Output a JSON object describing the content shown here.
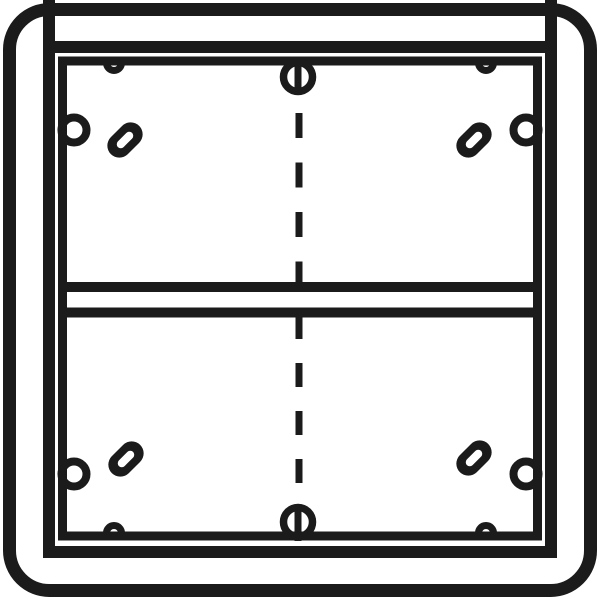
{
  "drawing": {
    "name": "surface-mount-frame-technical-drawing",
    "description": "black line technical drawing of a two-module surface mount frame",
    "canvas": {
      "width": 600,
      "height": 600
    },
    "colors": {
      "line": "#1b1b1b",
      "background": "#ffffff"
    },
    "shapes": [
      {
        "name": "outer-frame",
        "interactable": false,
        "tag": "rect",
        "attrs": {
          "x": 9.5,
          "y": 9.5,
          "width": 581,
          "height": 581,
          "rx": 40,
          "ry": 40,
          "fill": "none",
          "stroke": "#1b1b1b",
          "stroke-width": 13
        }
      },
      {
        "name": "corner-tick-top-left",
        "interactable": false,
        "tag": "line",
        "attrs": {
          "x1": 49,
          "y1": 0,
          "x2": 49,
          "y2": 53,
          "stroke": "#1b1b1b",
          "stroke-width": 12
        }
      },
      {
        "name": "corner-tick-top-right",
        "interactable": false,
        "tag": "line",
        "attrs": {
          "x1": 551,
          "y1": 0,
          "x2": 551,
          "y2": 53,
          "stroke": "#1b1b1b",
          "stroke-width": 12
        }
      },
      {
        "name": "frame-inner-edge",
        "interactable": false,
        "tag": "rect",
        "attrs": {
          "x": 49,
          "y": 47,
          "width": 502,
          "height": 505,
          "fill": "none",
          "stroke": "#1b1b1b",
          "stroke-width": 12
        }
      },
      {
        "name": "mounting-box-outline",
        "interactable": false,
        "tag": "rect",
        "attrs": {
          "x": 62.5,
          "y": 61,
          "width": 475,
          "height": 475,
          "fill": "none",
          "stroke": "#1b1b1b",
          "stroke-width": 9
        }
      },
      {
        "name": "divider-bar-upper-line",
        "interactable": false,
        "tag": "line",
        "attrs": {
          "x1": 66,
          "y1": 287,
          "x2": 534,
          "y2": 287,
          "stroke": "#1b1b1b",
          "stroke-width": 10,
          "stroke-linecap": "round"
        }
      },
      {
        "name": "divider-bar-lower-line",
        "interactable": false,
        "tag": "line",
        "attrs": {
          "x1": 66,
          "y1": 312.5,
          "x2": 534,
          "y2": 312.5,
          "stroke": "#1b1b1b",
          "stroke-width": 10,
          "stroke-linecap": "round"
        }
      },
      {
        "name": "center-dashed-line-top",
        "interactable": false,
        "tag": "line",
        "attrs": {
          "x1": 299,
          "y1": 113,
          "x2": 299,
          "y2": 287,
          "stroke": "#1b1b1b",
          "stroke-width": 7,
          "stroke-dasharray": "25 24.5"
        }
      },
      {
        "name": "center-dashed-line-bottom",
        "interactable": false,
        "tag": "line",
        "attrs": {
          "x1": 299,
          "y1": 315,
          "x2": 299,
          "y2": 510,
          "stroke": "#1b1b1b",
          "stroke-width": 7,
          "stroke-dasharray": "24 24"
        }
      },
      {
        "name": "screw-head-top-circle",
        "interactable": false,
        "tag": "circle",
        "attrs": {
          "cx": 298,
          "cy": 77,
          "r": 14.5,
          "fill": "none",
          "stroke": "#1b1b1b",
          "stroke-width": 7.5
        }
      },
      {
        "name": "screw-head-top-slot",
        "interactable": false,
        "tag": "line",
        "attrs": {
          "x1": 298,
          "y1": 58,
          "x2": 298,
          "y2": 94,
          "stroke": "#1b1b1b",
          "stroke-width": 7
        }
      },
      {
        "name": "screw-head-bottom-circle",
        "interactable": false,
        "tag": "circle",
        "attrs": {
          "cx": 298,
          "cy": 522,
          "r": 14.5,
          "fill": "none",
          "stroke": "#1b1b1b",
          "stroke-width": 7.5
        }
      },
      {
        "name": "screw-head-bottom-slot",
        "interactable": false,
        "tag": "line",
        "attrs": {
          "x1": 298,
          "y1": 505,
          "x2": 298,
          "y2": 541,
          "stroke": "#1b1b1b",
          "stroke-width": 7
        }
      },
      {
        "name": "wall-notch-left-top",
        "interactable": false,
        "tag": "circle",
        "attrs": {
          "cx": 74,
          "cy": 130,
          "r": 12.5,
          "fill": "none",
          "stroke": "#1b1b1b",
          "stroke-width": 8
        }
      },
      {
        "name": "wall-notch-right-top",
        "interactable": false,
        "tag": "circle",
        "attrs": {
          "cx": 526,
          "cy": 130,
          "r": 12.5,
          "fill": "none",
          "stroke": "#1b1b1b",
          "stroke-width": 8
        }
      },
      {
        "name": "wall-notch-left-bottom",
        "interactable": false,
        "tag": "circle",
        "attrs": {
          "cx": 74,
          "cy": 474,
          "r": 12.5,
          "fill": "none",
          "stroke": "#1b1b1b",
          "stroke-width": 8
        }
      },
      {
        "name": "wall-notch-right-bottom",
        "interactable": false,
        "tag": "circle",
        "attrs": {
          "cx": 526,
          "cy": 474,
          "r": 12.5,
          "fill": "none",
          "stroke": "#1b1b1b",
          "stroke-width": 8
        }
      },
      {
        "name": "edge-bump-top-left",
        "interactable": false,
        "tag": "path",
        "attrs": {
          "d": "M 106.5 63 A 7.5 7.5 0 0 0 121.5 63",
          "fill": "none",
          "stroke": "#1b1b1b",
          "stroke-width": 7
        }
      },
      {
        "name": "edge-bump-top-right",
        "interactable": false,
        "tag": "path",
        "attrs": {
          "d": "M 478.5 63 A 7.5 7.5 0 0 0 493.5 63",
          "fill": "none",
          "stroke": "#1b1b1b",
          "stroke-width": 7
        }
      },
      {
        "name": "edge-bump-bottom-left",
        "interactable": false,
        "tag": "path",
        "attrs": {
          "d": "M 106.5 533 A 7.5 7.5 0 0 1 121.5 533",
          "fill": "none",
          "stroke": "#1b1b1b",
          "stroke-width": 7
        }
      },
      {
        "name": "edge-bump-bottom-right",
        "interactable": false,
        "tag": "path",
        "attrs": {
          "d": "M 478.5 533 A 7.5 7.5 0 0 1 493.5 533",
          "fill": "none",
          "stroke": "#1b1b1b",
          "stroke-width": 7
        }
      },
      {
        "name": "screw-slot-hole-top-left-body",
        "interactable": false,
        "tag": "rect",
        "attrs": {
          "x": -12,
          "y": -20,
          "width": 24,
          "height": 40,
          "rx": 12,
          "ry": 12,
          "fill": "#1b1b1b",
          "transform": "translate(125,140) rotate(45)"
        }
      },
      {
        "name": "screw-slot-hole-top-left-slot",
        "interactable": false,
        "tag": "rect",
        "attrs": {
          "x": -4,
          "y": -10,
          "width": 8,
          "height": 20,
          "rx": 4,
          "ry": 4,
          "fill": "#ffffff",
          "transform": "translate(125,140) rotate(45)"
        }
      },
      {
        "name": "screw-slot-hole-top-right-body",
        "interactable": false,
        "tag": "rect",
        "attrs": {
          "x": -12,
          "y": -20,
          "width": 24,
          "height": 40,
          "rx": 12,
          "ry": 12,
          "fill": "#1b1b1b",
          "transform": "translate(474,140) rotate(45)"
        }
      },
      {
        "name": "screw-slot-hole-top-right-slot",
        "interactable": false,
        "tag": "rect",
        "attrs": {
          "x": -4,
          "y": -10,
          "width": 8,
          "height": 20,
          "rx": 4,
          "ry": 4,
          "fill": "#ffffff",
          "transform": "translate(474,140) rotate(45)"
        }
      },
      {
        "name": "screw-slot-hole-bottom-left-body",
        "interactable": false,
        "tag": "rect",
        "attrs": {
          "x": -12,
          "y": -20,
          "width": 24,
          "height": 40,
          "rx": 12,
          "ry": 12,
          "fill": "#1b1b1b",
          "transform": "translate(126,459) rotate(45)"
        }
      },
      {
        "name": "screw-slot-hole-bottom-left-slot",
        "interactable": false,
        "tag": "rect",
        "attrs": {
          "x": -4,
          "y": -10,
          "width": 8,
          "height": 20,
          "rx": 4,
          "ry": 4,
          "fill": "#ffffff",
          "transform": "translate(126,459) rotate(45)"
        }
      },
      {
        "name": "screw-slot-hole-bottom-right-body",
        "interactable": false,
        "tag": "rect",
        "attrs": {
          "x": -12,
          "y": -20,
          "width": 24,
          "height": 40,
          "rx": 12,
          "ry": 12,
          "fill": "#1b1b1b",
          "transform": "translate(474,458) rotate(45)"
        }
      },
      {
        "name": "screw-slot-hole-bottom-right-slot",
        "interactable": false,
        "tag": "rect",
        "attrs": {
          "x": -4,
          "y": -10,
          "width": 8,
          "height": 20,
          "rx": 4,
          "ry": 4,
          "fill": "#ffffff",
          "transform": "translate(474,458) rotate(45)"
        }
      }
    ]
  }
}
